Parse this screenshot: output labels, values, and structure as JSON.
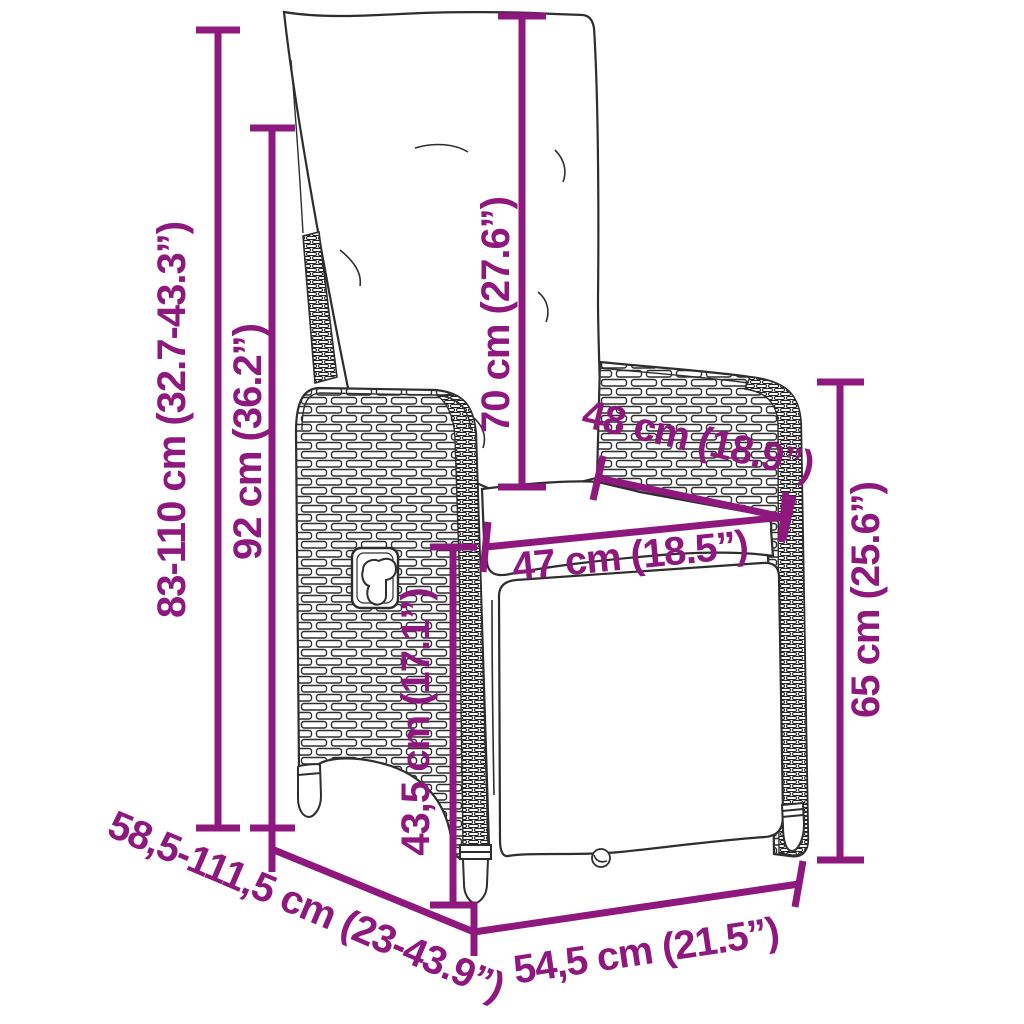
{
  "diagram": {
    "title": "Reclining garden chair with cushions - dimension diagram",
    "accent_color": "#8E187E",
    "line_color": "#2E2E2E"
  },
  "dimensions": [
    {
      "id": "overall-height",
      "label": "83-110 cm (32.7-43.3”)"
    },
    {
      "id": "backrest-height",
      "label": "92 cm (36.2”)"
    },
    {
      "id": "back-cushion-height",
      "label": "70 cm (27.6”)"
    },
    {
      "id": "armrest-length",
      "label": "48 cm (18.9”)"
    },
    {
      "id": "seat-width",
      "label": "47 cm (18.5”)"
    },
    {
      "id": "armrest-height",
      "label": "65 cm (25.6”)"
    },
    {
      "id": "seat-height",
      "label": "43,5 cm (17.1”)"
    },
    {
      "id": "depth-range",
      "label": "58,5-111,5 cm (23-43.9”)"
    },
    {
      "id": "base-width",
      "label": "54,5 cm (21.5”)"
    }
  ]
}
